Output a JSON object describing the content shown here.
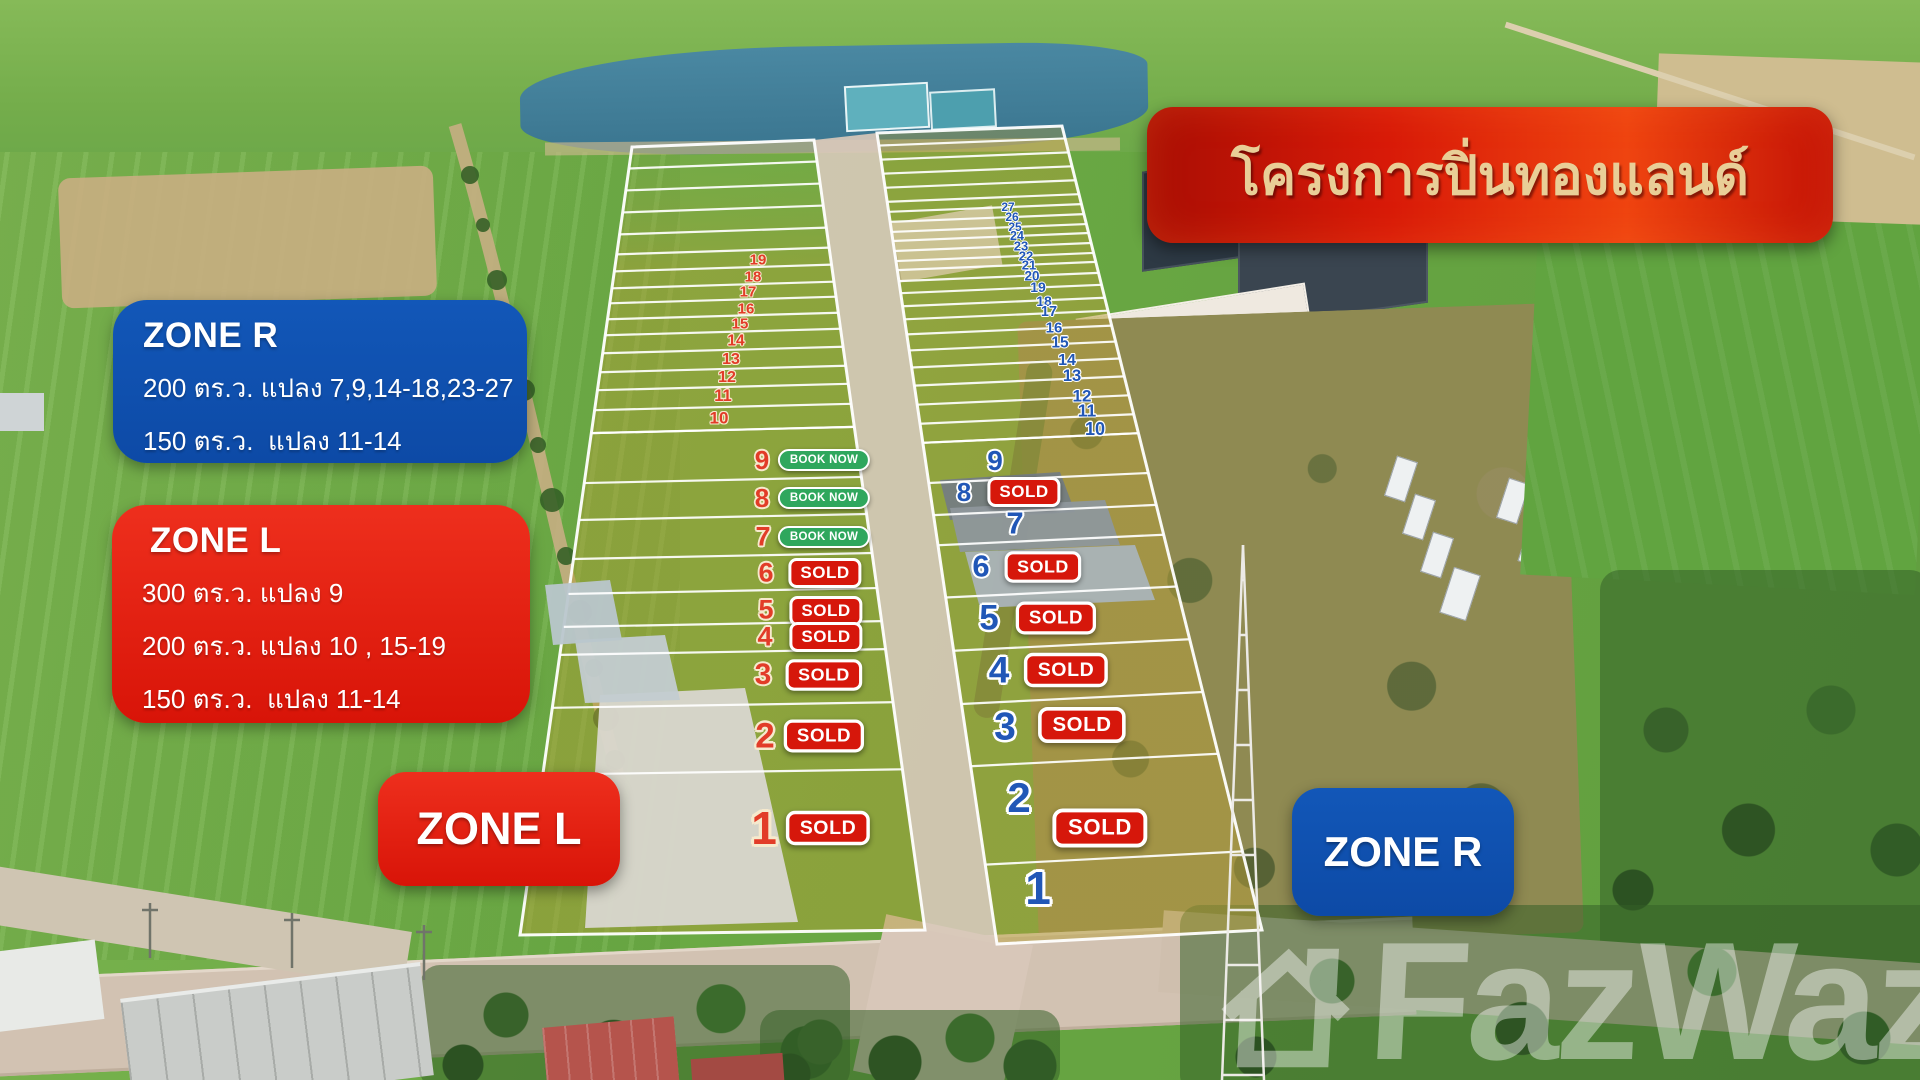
{
  "banner": {
    "title": "โครงการปิ่นทองแลนด์"
  },
  "zone_r_box": {
    "title": "ZONE R",
    "line1": "200 ตร.ว. แปลง 7,9,14-18,23-27",
    "line2": "150 ตร.ว.  แปลง 11-14"
  },
  "zone_l_box": {
    "title": "ZONE L",
    "line1": "300 ตร.ว. แปลง 9",
    "line2": "200 ตร.ว. แปลง 10 , 15-19",
    "line3": "150 ตร.ว.  แปลง 11-14"
  },
  "zone_l_badge": {
    "label": "ZONE L"
  },
  "zone_r_badge": {
    "label": "ZONE R"
  },
  "badges": {
    "sold": "SOLD",
    "book_now": "BOOK NOW"
  },
  "watermark": {
    "text": "FazWaz"
  },
  "colors": {
    "num_red": "#e23c28",
    "red_outline": "#f6e9cd",
    "num_blue": "#2157b7",
    "blue_outline": "#ffffff",
    "sold_bg": "#d6170b",
    "book_now_bg": "#2fa75d",
    "zone_red": "#e42415",
    "zone_blue": "#0f51b0",
    "banner_red": "#d81a08",
    "title_text": "#e9ce97"
  },
  "plot_map": {
    "left_column": {
      "zone": "L",
      "corners": {
        "tl": [
          632,
          147
        ],
        "tr": [
          814,
          140
        ],
        "br": [
          925,
          930
        ],
        "bl": [
          520,
          935
        ]
      },
      "unnumbered_dividers": [
        165,
        187,
        209,
        231
      ],
      "strips_bottom": 430,
      "strips": [
        {
          "n": "19",
          "x": 758,
          "y": 260,
          "top": 251,
          "s": 15
        },
        {
          "n": "18",
          "x": 753,
          "y": 277,
          "top": 268,
          "s": 15
        },
        {
          "n": "17",
          "x": 748,
          "y": 292,
          "top": 285,
          "s": 15
        },
        {
          "n": "16",
          "x": 746,
          "y": 309,
          "top": 300,
          "s": 15
        },
        {
          "n": "15",
          "x": 740,
          "y": 324,
          "top": 316,
          "s": 15
        },
        {
          "n": "14",
          "x": 736,
          "y": 341,
          "top": 332,
          "s": 15.5
        },
        {
          "n": "13",
          "x": 731,
          "y": 360,
          "top": 350,
          "s": 16
        },
        {
          "n": "12",
          "x": 727,
          "y": 378,
          "top": 369,
          "s": 16
        },
        {
          "n": "11",
          "x": 723,
          "y": 396,
          "top": 387,
          "s": 16.5
        },
        {
          "n": "10",
          "x": 719,
          "y": 418,
          "top": 407,
          "s": 17
        }
      ],
      "plots": [
        {
          "n": "9",
          "x": 762,
          "y": 460,
          "top": 430,
          "s": 26,
          "badge": "book_now",
          "bx": 824,
          "by": 460
        },
        {
          "n": "8",
          "x": 762,
          "y": 498,
          "top": 480,
          "s": 26,
          "badge": "book_now",
          "bx": 824,
          "by": 498
        },
        {
          "n": "7",
          "x": 763,
          "y": 537,
          "top": 517,
          "s": 27,
          "badge": "book_now",
          "bx": 824,
          "by": 537
        },
        {
          "n": "6",
          "x": 766,
          "y": 573,
          "top": 556,
          "s": 27,
          "badge": "sold",
          "bx": 825,
          "by": 573
        },
        {
          "n": "5",
          "x": 766,
          "y": 610,
          "top": 591,
          "s": 27,
          "badge": "sold",
          "bx": 826,
          "by": 611
        },
        {
          "n": "4",
          "x": 765,
          "y": 637,
          "top": 624,
          "s": 27,
          "badge": "sold",
          "bx": 826,
          "by": 637
        },
        {
          "n": "3",
          "x": 763,
          "y": 675,
          "top": 652,
          "s": 30,
          "badge": "sold",
          "bx": 824,
          "by": 675,
          "bs": 1.05
        },
        {
          "n": "2",
          "x": 765,
          "y": 736,
          "top": 705,
          "s": 35,
          "badge": "sold",
          "bx": 824,
          "by": 736,
          "bs": 1.1
        },
        {
          "n": "1",
          "x": 764,
          "y": 828,
          "top": 772,
          "s": 46,
          "badge": "sold",
          "bx": 828,
          "by": 828,
          "bs": 1.15
        }
      ]
    },
    "right_column": {
      "zone": "R",
      "corners": {
        "tl": [
          877,
          133
        ],
        "tr": [
          1062,
          126
        ],
        "br": [
          1262,
          930
        ],
        "bl": [
          997,
          944
        ]
      },
      "unnumbered_dividers": [
        142,
        156,
        170,
        184
      ],
      "strips_bottom": 438,
      "strips": [
        {
          "n": "27",
          "x": 1008,
          "y": 207,
          "top": 198,
          "s": 12
        },
        {
          "n": "26",
          "x": 1012,
          "y": 217,
          "top": 208,
          "s": 12
        },
        {
          "n": "25",
          "x": 1015,
          "y": 227,
          "top": 218,
          "s": 12
        },
        {
          "n": "24",
          "x": 1017,
          "y": 236,
          "top": 228,
          "s": 12.5
        },
        {
          "n": "23",
          "x": 1021,
          "y": 246,
          "top": 237,
          "s": 13
        },
        {
          "n": "22",
          "x": 1026,
          "y": 256,
          "top": 247,
          "s": 13
        },
        {
          "n": "21",
          "x": 1029,
          "y": 265,
          "top": 257,
          "s": 13
        },
        {
          "n": "20",
          "x": 1032,
          "y": 276,
          "top": 266,
          "s": 13.5
        },
        {
          "n": "19",
          "x": 1038,
          "y": 287,
          "top": 277,
          "s": 14
        },
        {
          "n": "18",
          "x": 1044,
          "y": 301,
          "top": 289,
          "s": 14
        },
        {
          "n": "17",
          "x": 1049,
          "y": 312,
          "top": 302,
          "s": 14.5
        },
        {
          "n": "16",
          "x": 1054,
          "y": 328,
          "top": 315,
          "s": 15
        },
        {
          "n": "15",
          "x": 1060,
          "y": 343,
          "top": 330,
          "s": 15.5
        },
        {
          "n": "14",
          "x": 1067,
          "y": 361,
          "top": 346,
          "s": 16
        },
        {
          "n": "13",
          "x": 1072,
          "y": 376,
          "top": 363,
          "s": 16.5
        },
        {
          "n": "12",
          "x": 1082,
          "y": 396,
          "top": 381,
          "s": 17
        },
        {
          "n": "11",
          "x": 1087,
          "y": 411,
          "top": 400,
          "s": 17.5
        },
        {
          "n": "10",
          "x": 1095,
          "y": 429,
          "top": 419,
          "s": 18
        }
      ],
      "plots": [
        {
          "n": "9",
          "x": 995,
          "y": 461,
          "top": 438,
          "s": 28
        },
        {
          "n": "8",
          "x": 964,
          "y": 492,
          "top": 478,
          "s": 26,
          "badge": "sold",
          "bx": 1024,
          "by": 492
        },
        {
          "n": "7",
          "x": 1015,
          "y": 523,
          "top": 510,
          "s": 31
        },
        {
          "n": "6",
          "x": 981,
          "y": 566,
          "top": 540,
          "s": 31,
          "badge": "sold",
          "bx": 1043,
          "by": 567,
          "bs": 1.05
        },
        {
          "n": "5",
          "x": 989,
          "y": 618,
          "top": 592,
          "s": 35,
          "badge": "sold",
          "bx": 1056,
          "by": 618,
          "bs": 1.1
        },
        {
          "n": "4",
          "x": 999,
          "y": 670,
          "top": 645,
          "s": 37,
          "badge": "sold",
          "bx": 1066,
          "by": 670,
          "bs": 1.15
        },
        {
          "n": "3",
          "x": 1005,
          "y": 727,
          "top": 698,
          "s": 39,
          "badge": "sold",
          "bx": 1082,
          "by": 725,
          "bs": 1.2
        },
        {
          "n": "2",
          "x": 1019,
          "y": 798,
          "top": 760,
          "s": 42,
          "badge": "sold",
          "bx": 1100,
          "by": 828,
          "bs": 1.3
        },
        {
          "n": "1",
          "x": 1038,
          "y": 888,
          "top": 858,
          "s": 46
        }
      ]
    }
  }
}
